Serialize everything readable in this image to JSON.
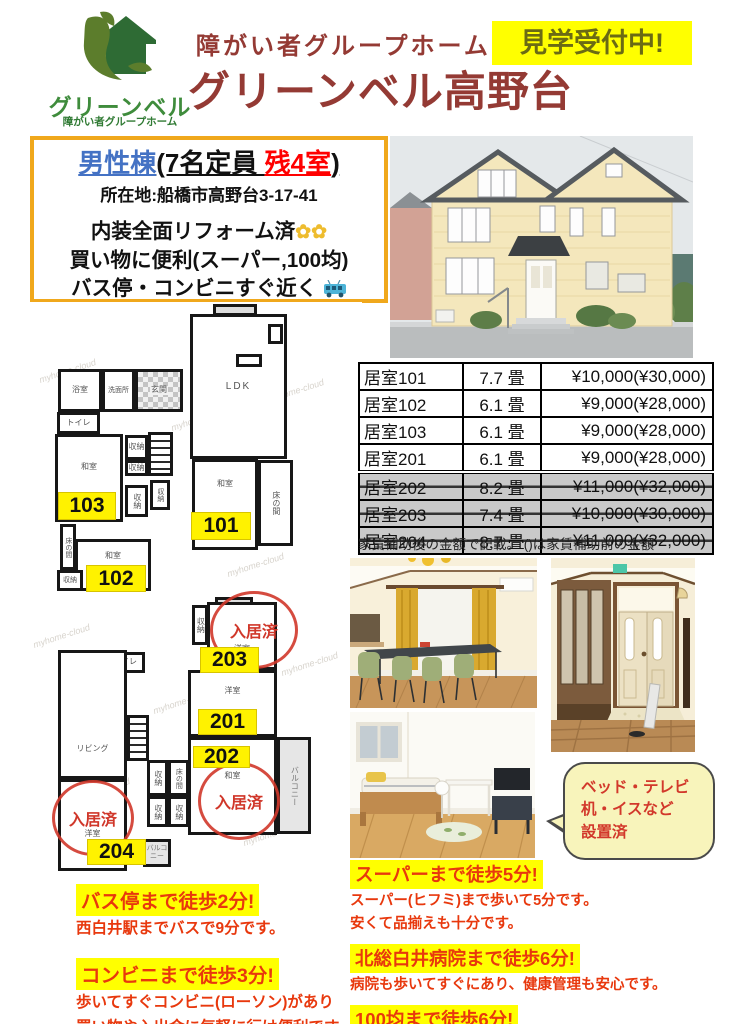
{
  "header": {
    "logo": {
      "brand": "グリーンベル",
      "tagline": "障がい者グループホーム"
    },
    "category": "障がい者グループホーム",
    "title": "グリーンベル高野台",
    "badge": "見学受付中!"
  },
  "info": {
    "building": "男性棟",
    "capacity_prefix": "(7名定員 ",
    "vacancy": "残4室",
    "capacity_suffix": ")",
    "address": "所在地:船橋市高野台3-17-41",
    "features": [
      "内装全面リフォーム済",
      "買い物に便利(スーパー,100均)",
      "バス停・コンビニすぐ近く"
    ]
  },
  "price_table": {
    "rows": [
      {
        "room": "居室101",
        "size": "7.7 畳",
        "price": "¥10,000(¥30,000)",
        "occupied": false
      },
      {
        "room": "居室102",
        "size": "6.1 畳",
        "price": "¥9,000(¥28,000)",
        "occupied": false
      },
      {
        "room": "居室103",
        "size": "6.1 畳",
        "price": "¥9,000(¥28,000)",
        "occupied": false
      },
      {
        "room": "居室201",
        "size": "6.1 畳",
        "price": "¥9,000(¥28,000)",
        "occupied": false
      },
      {
        "room": "居室202",
        "size": "8.2 畳",
        "price": "¥11,000(¥32,000)",
        "occupied": true
      },
      {
        "room": "居室203",
        "size": "7.4 畳",
        "price": "¥10,000(¥30,000)",
        "occupied": true
      },
      {
        "room": "居室204",
        "size": "8.7 畳",
        "price": "¥11,000(¥32,000)",
        "occupied": true
      }
    ],
    "note": "家賃補助後の金額で記載。 ()は家賃補助前の金額"
  },
  "floorplans": {
    "labels": {
      "bath": "浴室",
      "washroom": "洗面所",
      "entrance": "玄関",
      "ldk": "LDK",
      "toilet": "トイレ",
      "japanese_room": "和室",
      "closet": "収納",
      "alcove": "床の間",
      "living": "リビング",
      "western_room": "洋室",
      "balcony": "バルコニー",
      "occupied": "入居済"
    },
    "tags": {
      "r101": "101",
      "r102": "102",
      "r103": "103",
      "r201": "201",
      "r202": "202",
      "r203": "203",
      "r204": "204"
    },
    "watermark": "myhome-cloud"
  },
  "bubble": {
    "lines": [
      "ベッド・テレビ",
      "机・イスなど",
      "設置済"
    ]
  },
  "access_left": [
    {
      "headline": "バス停まで徒歩2分!",
      "body": [
        "西白井駅までバスで9分です。"
      ]
    },
    {
      "headline": "コンビニまで徒歩3分!",
      "body": [
        "歩いてすぐコンビニ(ローソン)があり",
        "買い物や入出金に気軽に行け便利です。"
      ]
    }
  ],
  "access_right": [
    {
      "headline": "スーパーまで徒歩5分!",
      "body": [
        "スーパー(ヒフミ)まで歩いて5分です。",
        "安くて品揃えも十分です。"
      ]
    },
    {
      "headline": "北総白井病院まで徒歩6分!",
      "body": [
        "病院も歩いてすぐにあり、健康管理も安心です。"
      ]
    },
    {
      "headline": "100均まで徒歩6分!",
      "body": [
        "100均(セリア)まで歩いて6分。"
      ]
    }
  ],
  "colors": {
    "title_red": "#943a34",
    "vivid_red": "#e8380d",
    "highlight_yellow": "#ffff00",
    "info_border_orange": "#f0a81c",
    "building_blue": "#4472c4",
    "vacancy_red": "#ff0000",
    "occupied_gray": "#c9c9c9",
    "brand_green": "#2e6b34",
    "tag_yellow": "#fff200"
  }
}
